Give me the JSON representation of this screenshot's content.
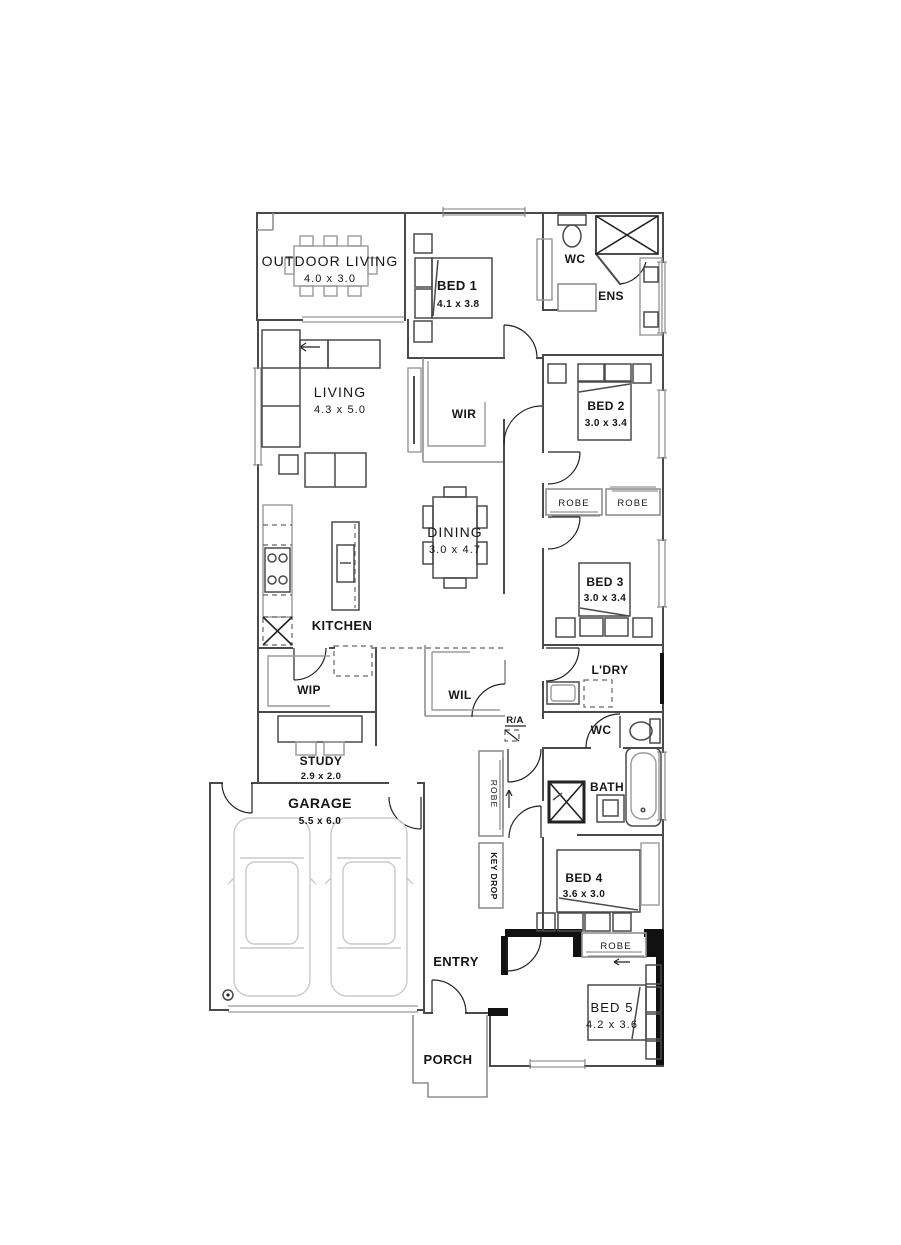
{
  "plan_title": "Single storey house floor plan",
  "colors": {
    "ink": "#161616",
    "wall": "#4a4a4a",
    "furniture": "#9a9a9a",
    "faint": "#c9c9c9",
    "solid_wall": "#111111"
  },
  "rooms": {
    "outdoor_living": {
      "name": "OUTDOOR LIVING",
      "dims": "4.0 x 3.0"
    },
    "bed1": {
      "name": "BED 1",
      "dims": "4.1 x 3.8"
    },
    "ens_wc": {
      "name": "WC"
    },
    "ensuite": {
      "name": "ENS"
    },
    "living": {
      "name": "LIVING",
      "dims": "4.3 x 5.0"
    },
    "wir": {
      "name": "WIR"
    },
    "bed2": {
      "name": "BED 2",
      "dims": "3.0 x 3.4"
    },
    "bed2_robe": {
      "name": "ROBE"
    },
    "bed3_robe": {
      "name": "ROBE"
    },
    "dining": {
      "name": "DINING",
      "dims": "3.0 x 4.7"
    },
    "bed3": {
      "name": "BED 3",
      "dims": "3.0 x 3.4"
    },
    "kitchen": {
      "name": "KITCHEN"
    },
    "wip": {
      "name": "WIP"
    },
    "wil": {
      "name": "WIL"
    },
    "laundry": {
      "name": "L'DRY"
    },
    "return_air": {
      "name": "R/A"
    },
    "wc": {
      "name": "WC"
    },
    "bath": {
      "name": "BATH"
    },
    "hall_robe": {
      "name": "ROBE"
    },
    "key_drop": {
      "name": "KEY DROP"
    },
    "study": {
      "name": "STUDY",
      "dims": "2.9 x 2.0"
    },
    "garage": {
      "name": "GARAGE",
      "dims": "5.5 x 6.0"
    },
    "bed4": {
      "name": "BED 4",
      "dims": "3.6 x 3.0"
    },
    "entry": {
      "name": "ENTRY"
    },
    "bed5_robe": {
      "name": "ROBE"
    },
    "bed5": {
      "name": "BED 5",
      "dims": "4.2 x 3.6"
    },
    "porch": {
      "name": "PORCH"
    }
  }
}
